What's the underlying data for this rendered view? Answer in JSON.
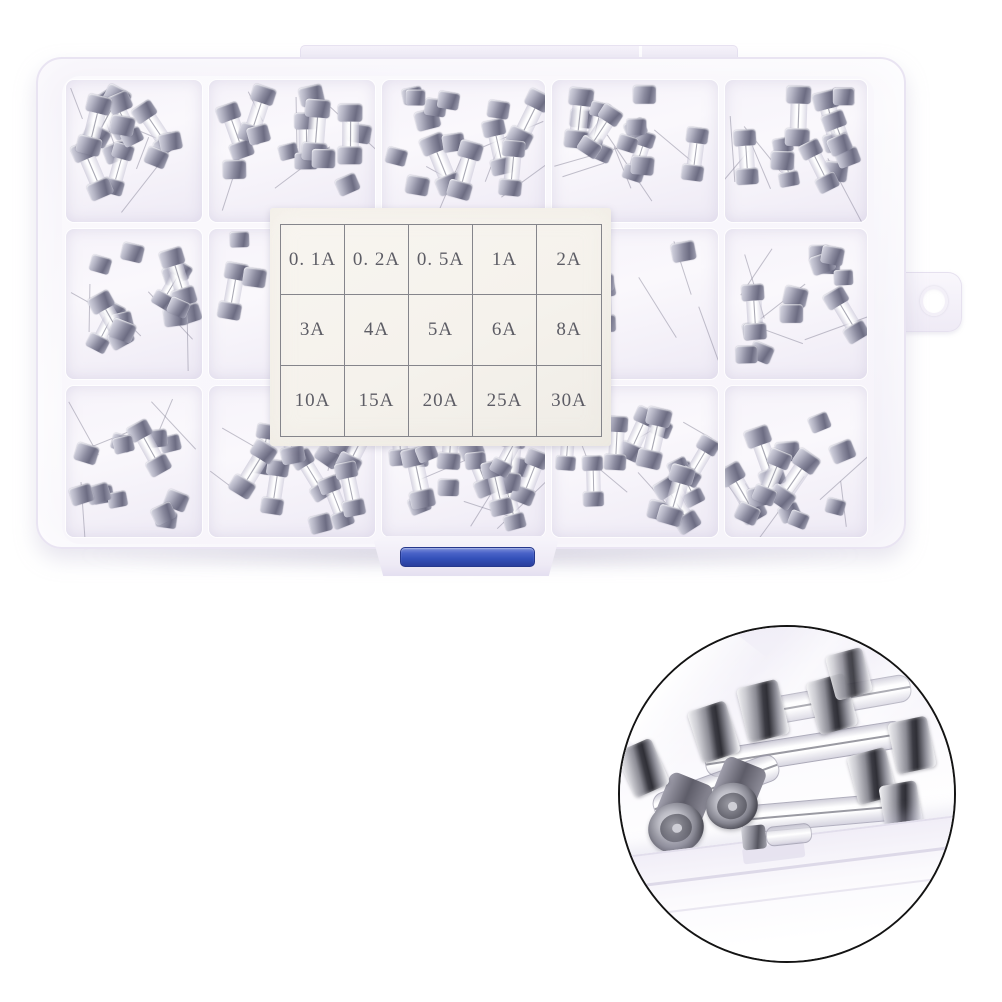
{
  "label_card": {
    "rows": [
      [
        "0. 1A",
        "0. 2A",
        "0. 5A",
        "1A",
        "2A"
      ],
      [
        "3A",
        "4A",
        "5A",
        "6A",
        "8A"
      ],
      [
        "10A",
        "15A",
        "20A",
        "25A",
        "30A"
      ]
    ]
  },
  "colors": {
    "background": "#ffffff",
    "latch_blue": "#3350b8",
    "inset_border": "#141414",
    "fuse_cap_silver": "#8a8a9e",
    "box_plastic_tint": "#f1eef7",
    "label_paper": "#f5f2ec"
  }
}
